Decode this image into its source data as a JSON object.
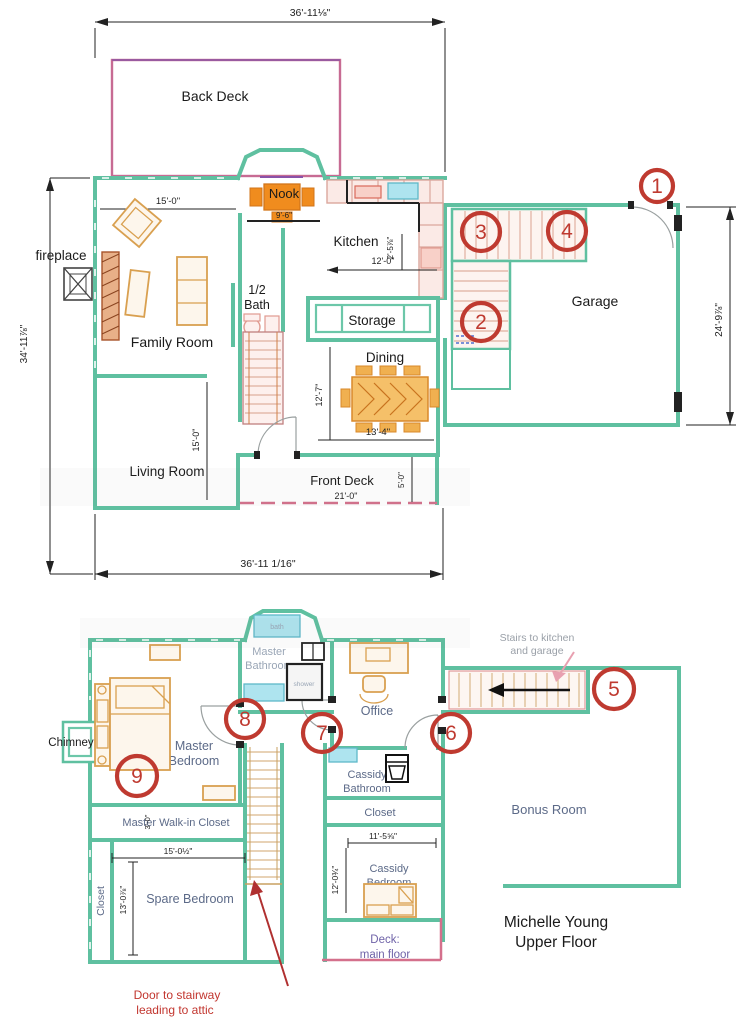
{
  "colors": {
    "wall_teal": "#5fc0a0",
    "counter_pink": "#dba79d",
    "furniture_orange": "#d9a050",
    "deck_pink": "#d4708c",
    "fixture_cyan": "#aee4ef",
    "callout_red": "#bf3a30",
    "note_red": "#c2362f",
    "room_label_slate": "#5c6a88",
    "muted_gray": "#9aa6b6",
    "deck_label_purple": "#6f63a8",
    "dimension_black": "#222222"
  },
  "main_floor": {
    "rooms": {
      "back_deck": "Back Deck",
      "nook": "Nook",
      "kitchen": "Kitchen",
      "fireplace": "fireplace",
      "family_room": "Family Room",
      "half_bath_line1": "1/2",
      "half_bath_line2": "Bath",
      "storage": "Storage",
      "dining": "Dining",
      "living_room": "Living Room",
      "front_deck": "Front Deck",
      "garage": "Garage"
    },
    "dimensions": {
      "top_width": "36'-11⅛\"",
      "bottom_width": "36'-11 1/16\"",
      "left_height": "34'-11⅞\"",
      "garage_height": "24'-9⅞\"",
      "family_width": "15'-0\"",
      "living_height": "15'-0\"",
      "nook_width": "9'-6\"",
      "kitchen_width": "12'-0\"",
      "kitchen_depth": "2'-5⅞\"",
      "dining_width": "13'-4\"",
      "dining_height": "12'-7\"",
      "front_deck_width": "21'-0\"",
      "front_deck_depth": "5'-0\""
    },
    "callouts": [
      "1",
      "2",
      "3",
      "4"
    ]
  },
  "upper_floor": {
    "rooms": {
      "bath": "bath",
      "master_bathroom_line1": "Master",
      "master_bathroom_line2": "Bathroom",
      "shower": "shower",
      "office": "Office",
      "chimney": "Chimney",
      "master_bedroom_line1": "Master",
      "master_bedroom_line2": "Bedroom",
      "cassidy_bathroom_line1": "Cassidy",
      "cassidy_bathroom_line2": "Bathroom",
      "closet": "Closet",
      "bonus_room": "Bonus Room",
      "walk_in_closet": "Master Walk-in Closet",
      "closet_left": "Closet",
      "spare_bedroom": "Spare Bedroom",
      "cassidy_bedroom_line1": "Cassidy",
      "cassidy_bedroom_line2": "Bedroom",
      "deck_line1": "Deck:",
      "deck_line2": "main floor"
    },
    "dimensions": {
      "walk_in_depth": "3'-0\"",
      "spare_width": "15'-0½\"",
      "spare_height": "13'-0⅞\"",
      "cassidy_width": "11'-5⅝\"",
      "cassidy_height": "12'-0¾\""
    },
    "notes": {
      "stairs_line1": "Stairs to kitchen",
      "stairs_line2": "and garage",
      "attic_line1": "Door to stairway",
      "attic_line2": "leading to attic"
    },
    "caption_line1": "Michelle Young",
    "caption_line2": "Upper Floor",
    "callouts": [
      "5",
      "6",
      "7",
      "8",
      "9"
    ]
  }
}
